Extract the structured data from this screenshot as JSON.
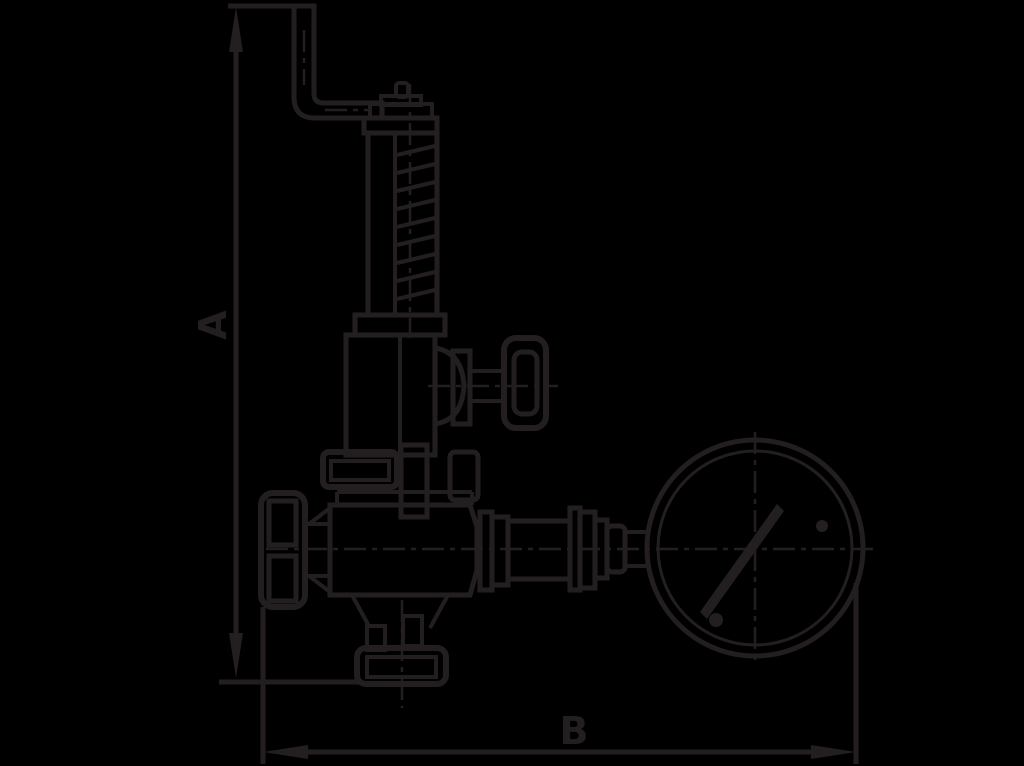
{
  "page": {
    "background_color": "#000000"
  },
  "drawing": {
    "line_color": "#231f20",
    "kind": "dimensioned outline drawing of a spring-loaded safety valve with lever, test handwheel and pressure gauge"
  },
  "dimensions": {
    "a": {
      "label": "A",
      "orientation": "vertical"
    },
    "b": {
      "label": "B",
      "orientation": "horizontal"
    }
  }
}
